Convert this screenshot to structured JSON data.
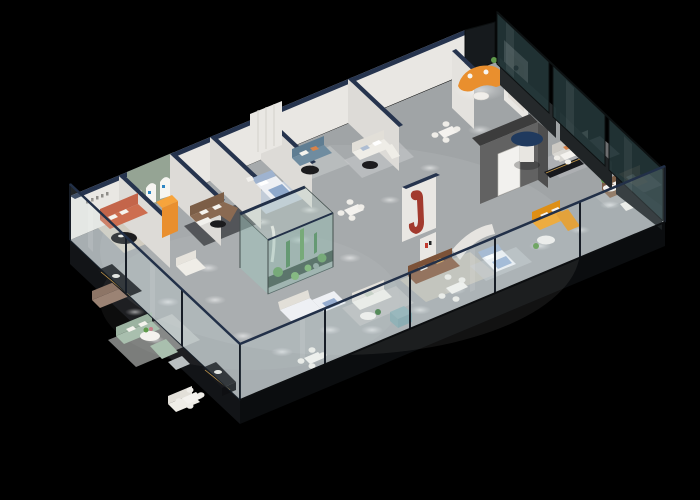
{
  "scene": {
    "description": "3D isometric cutaway floor plan render of a furniture showroom on a black background"
  },
  "palette": {
    "bg": "#000000",
    "floor": "#a0a4a6",
    "slab_left": "#121417",
    "slab_bottom": "#0b0d0f",
    "wall_white": "#e9e7e3",
    "wall_cap_navy": "#26344e",
    "wall_sage": "#95a494",
    "wall_dark_gray": "#626262",
    "door_white": "#f2f1ee",
    "glass_front": "rgba(205,228,235,0.16)",
    "glass_right": "rgba(36,56,58,0.88)",
    "glass_terrarium": "rgba(148,190,180,0.45)",
    "rail_navy": "#223048",
    "plant_dark": "#3f7a3f",
    "plant_mid": "#5f9a4a",
    "plant_light": "#7ab55c",
    "sofa_coral": "#cd6e50",
    "sofa_brown": "#8a6a52",
    "sofa_leather": "#8a5f45",
    "sofa_teal": "#6f8ca0",
    "sofa_sage": "#a9bfae",
    "sofa_yellow": "#f3a11f",
    "sofa_orange": "#e98f2e",
    "sofa_white": "#efede7",
    "sofa_gray": "#d9d7d2",
    "sofa_mauve": "#9b8374",
    "bed_blue": "#9fb3cf",
    "bed_white": "#eef0f4",
    "accent_red": "#a23a2e",
    "accent_amber": "#c79b4b",
    "ottoman_teal": "#8fb0b4",
    "console_black": "#17181c",
    "table_black": "#1c1c1e",
    "rug_dark": "#44464a",
    "rug_beige": "#d6cfc2",
    "rug_blue": "#c9d4e4",
    "rug_gray": "#c0c3c4",
    "logo_blue": "#2e86c4"
  },
  "features": [
    "coral-sofa-lounge",
    "arched-display-wall",
    "orange-display-stand",
    "brown-sectional",
    "blue-bed-display",
    "teal-sofa-lounge",
    "white-sofa-lounge",
    "greeter-room-orange-sofa",
    "woman-poster",
    "indoor-terrarium",
    "dark-feature-wall-with-door",
    "red-sculpture-wall",
    "navy-round-table",
    "yellow-sectional",
    "leather-sectional",
    "sage-sofa-group",
    "bed-displays",
    "dining-sets",
    "black-display-consoles",
    "glass-facade",
    "ceiling-spotlights"
  ]
}
